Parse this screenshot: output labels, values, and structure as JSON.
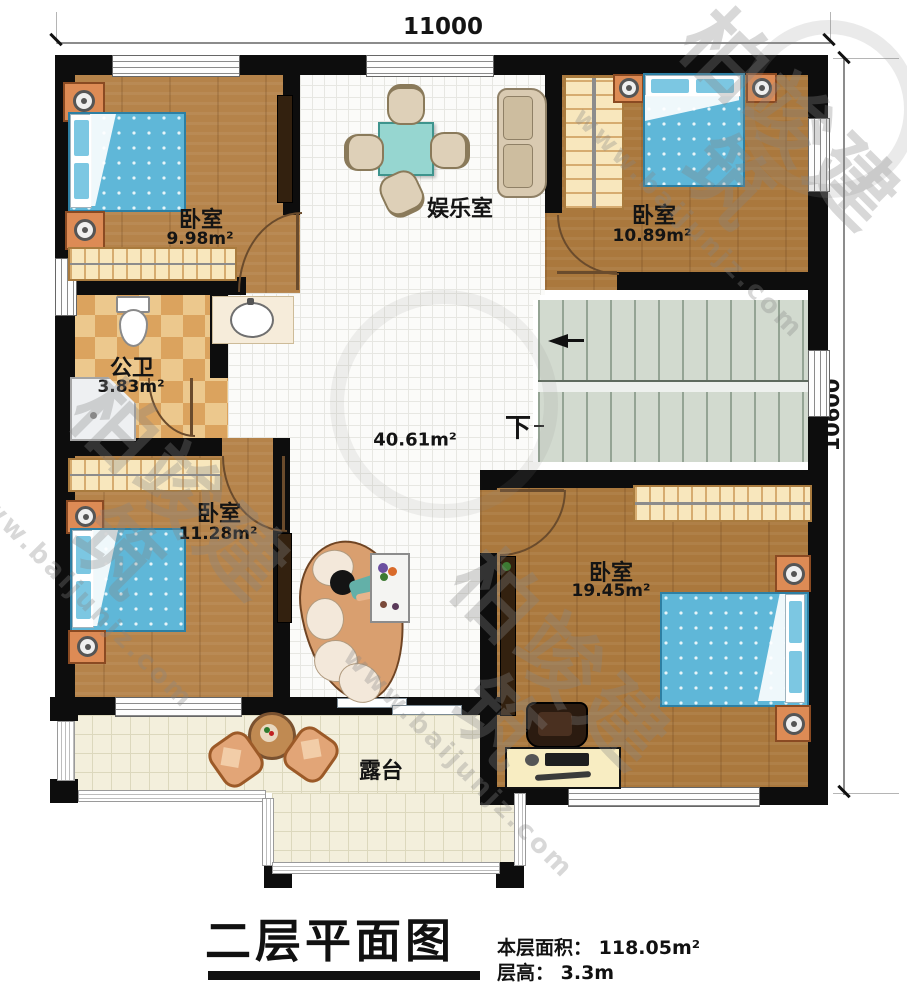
{
  "plan": {
    "dimension_top": "11000",
    "dimension_right": "10600",
    "rooms": {
      "bedroom_nw": {
        "name": "卧室",
        "area": "9.98m²"
      },
      "bedroom_ne": {
        "name": "卧室",
        "area": "10.89m²"
      },
      "bedroom_sw": {
        "name": "卧室",
        "area": "11.28m²"
      },
      "bedroom_se": {
        "name": "卧室",
        "area": "19.45m²"
      },
      "entertainment_room": {
        "name": "娱乐室"
      },
      "bathroom": {
        "name": "公卫",
        "area": "3.83m²"
      },
      "hall": {
        "area": "40.61m²"
      },
      "terrace": {
        "name": "露台"
      }
    },
    "stairs_down_label": "下"
  },
  "title_block": {
    "title": "二层平面图",
    "floor_area_label": "本层面积：",
    "floor_area_value": "118.05m²",
    "floor_height_label": "层高：",
    "floor_height_value": "3.3m"
  },
  "watermark": {
    "brand": "柏竣建筑",
    "site": "www.baijunjz.com"
  },
  "colors": {
    "wall": "#0d0d0d",
    "wood_floor": "#b5834a",
    "tile_floor": "#fbfbf9",
    "bath_tile_light": "#ecc88d",
    "bath_tile_dark": "#dba35e",
    "terrace_tile": "#f3efdc",
    "stair_tread": "#d2dacf",
    "bed_blue": "#5fb7d8",
    "nightstand_orange": "#dd8b55",
    "table_teal": "#96d6d0",
    "furniture_tan": "#ded0b8"
  }
}
